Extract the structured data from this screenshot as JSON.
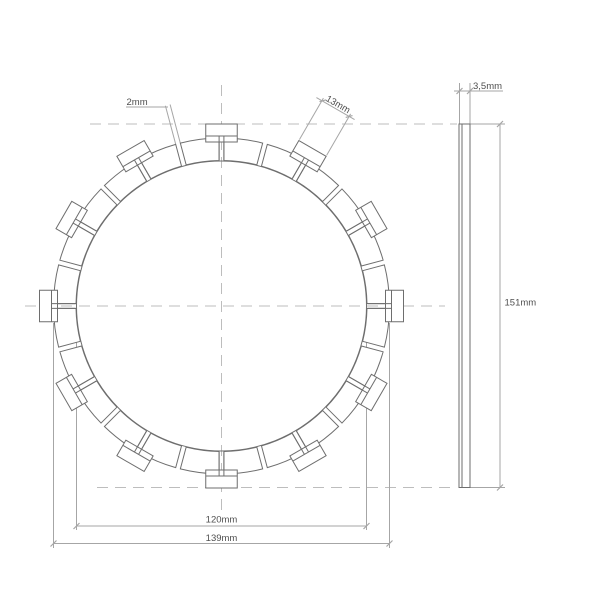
{
  "drawing": {
    "type": "technical-drawing",
    "part": "clutch friction plate",
    "front_view": {
      "pad_count": 24,
      "tab_count": 12,
      "labels": {
        "groove_width": "2mm",
        "tab_width": "13mm",
        "inner_diameter": "120mm",
        "outer_diameter": "139mm"
      }
    },
    "side_view": {
      "labels": {
        "thickness": "3,5mm",
        "overall_diameter": "151mm"
      }
    },
    "colors": {
      "background": "#ffffff",
      "outline": "#6e6e6e",
      "dimension": "#a6a6a6",
      "centerline": "#bdbdbd",
      "text": "#4f4f4f"
    }
  }
}
